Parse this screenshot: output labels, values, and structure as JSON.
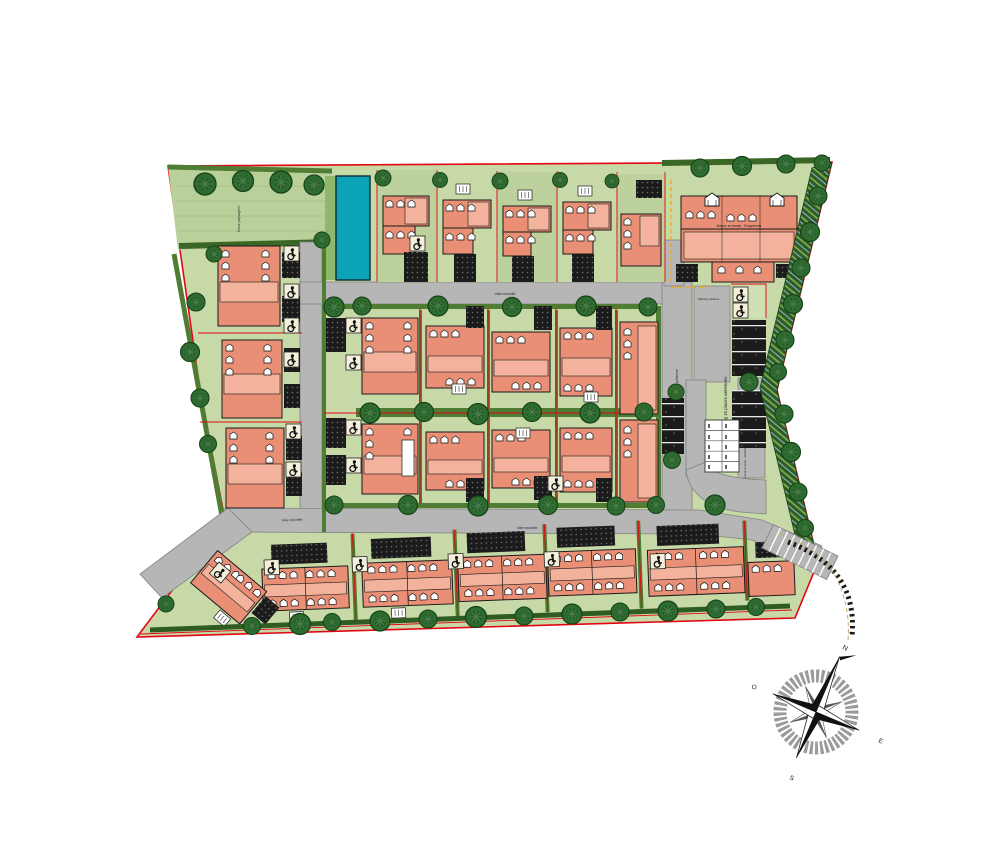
{
  "plan": {
    "title_hint": "Residential development site plan",
    "labels": {
      "parking_aerial": "Parking 16 places aériennes",
      "parking_visitors": "Parking visiteurs",
      "collective_building": "Maison en bande - 5 logements",
      "bike_refuse": "Local 2 roues - déchets",
      "swale": "Noue paysagère",
      "road_top": "Voie nouvelle",
      "road_bottom": "Voie nouvelle",
      "alley_right": "Allée piétonne"
    },
    "compass": {
      "north": "N",
      "east": "E",
      "south": "S",
      "west": "O"
    },
    "colors": {
      "boundary_red": "#e30613",
      "lawn": "#c8d9a8",
      "verge_green": "#4f7d33",
      "tree_green": "#2e6b2f",
      "road_gray": "#b6b6b6",
      "paving_black": "#1b1b1b",
      "house_salmon": "#e88f75",
      "house_light": "#f2b29c",
      "basin_teal": "#0aa4b6",
      "pmr_cream": "#f4efda",
      "accent_orange": "#f2a900"
    },
    "features": {
      "aerial_parking_spaces": 16,
      "garage_boxes": 10,
      "basin": "retention basin",
      "compass_rotation_deg": 23
    }
  }
}
